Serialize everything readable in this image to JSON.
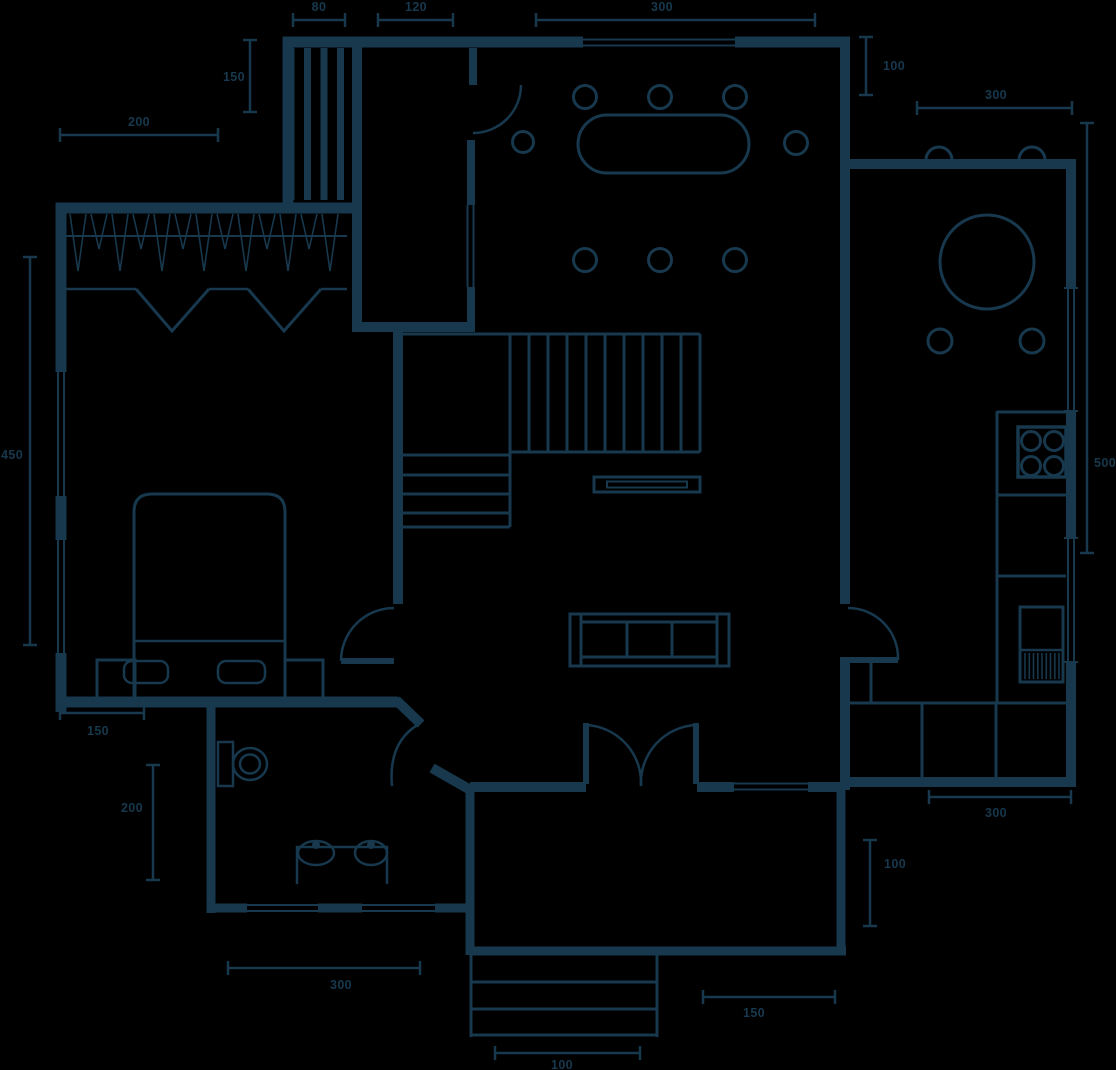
{
  "canvas": {
    "width": 1116,
    "height": 1070
  },
  "style": {
    "line_color": "#17384d",
    "background_color": "#000000"
  },
  "drawing": {
    "type": "architectural-floor-plan",
    "view": "top-down"
  },
  "dims": {
    "d80": "80",
    "d120": "120",
    "d300_top": "300",
    "d150_top_left": "150",
    "d200_top_left": "200",
    "d100_top_right": "100",
    "d300_top_right": "300",
    "d450_left": "450",
    "d500_right": "500",
    "d150_bedroom": "150",
    "d200_bathroom": "200",
    "d300_bathroom": "300",
    "d300_kitchen": "300",
    "d100_right_lower": "100",
    "d150_porch": "150",
    "d100_porch": "100"
  },
  "fixtures": [
    "wardrobe-hangers",
    "closet-bifold-doors",
    "shelf-unit",
    "double-bed",
    "pillows",
    "nightstands",
    "toilet",
    "double-sink-vanity",
    "staircase",
    "tv-unit",
    "sofa",
    "dining-table",
    "dining-chairs",
    "round-kitchen-table",
    "kitchen-chairs",
    "bar-stools",
    "cooktop-four-burners",
    "kitchen-sink-unit",
    "kitchen-counter",
    "front-door",
    "bedroom-door",
    "bathroom-door",
    "double-entry-doors",
    "kitchen-door",
    "windows",
    "porch-steps"
  ]
}
